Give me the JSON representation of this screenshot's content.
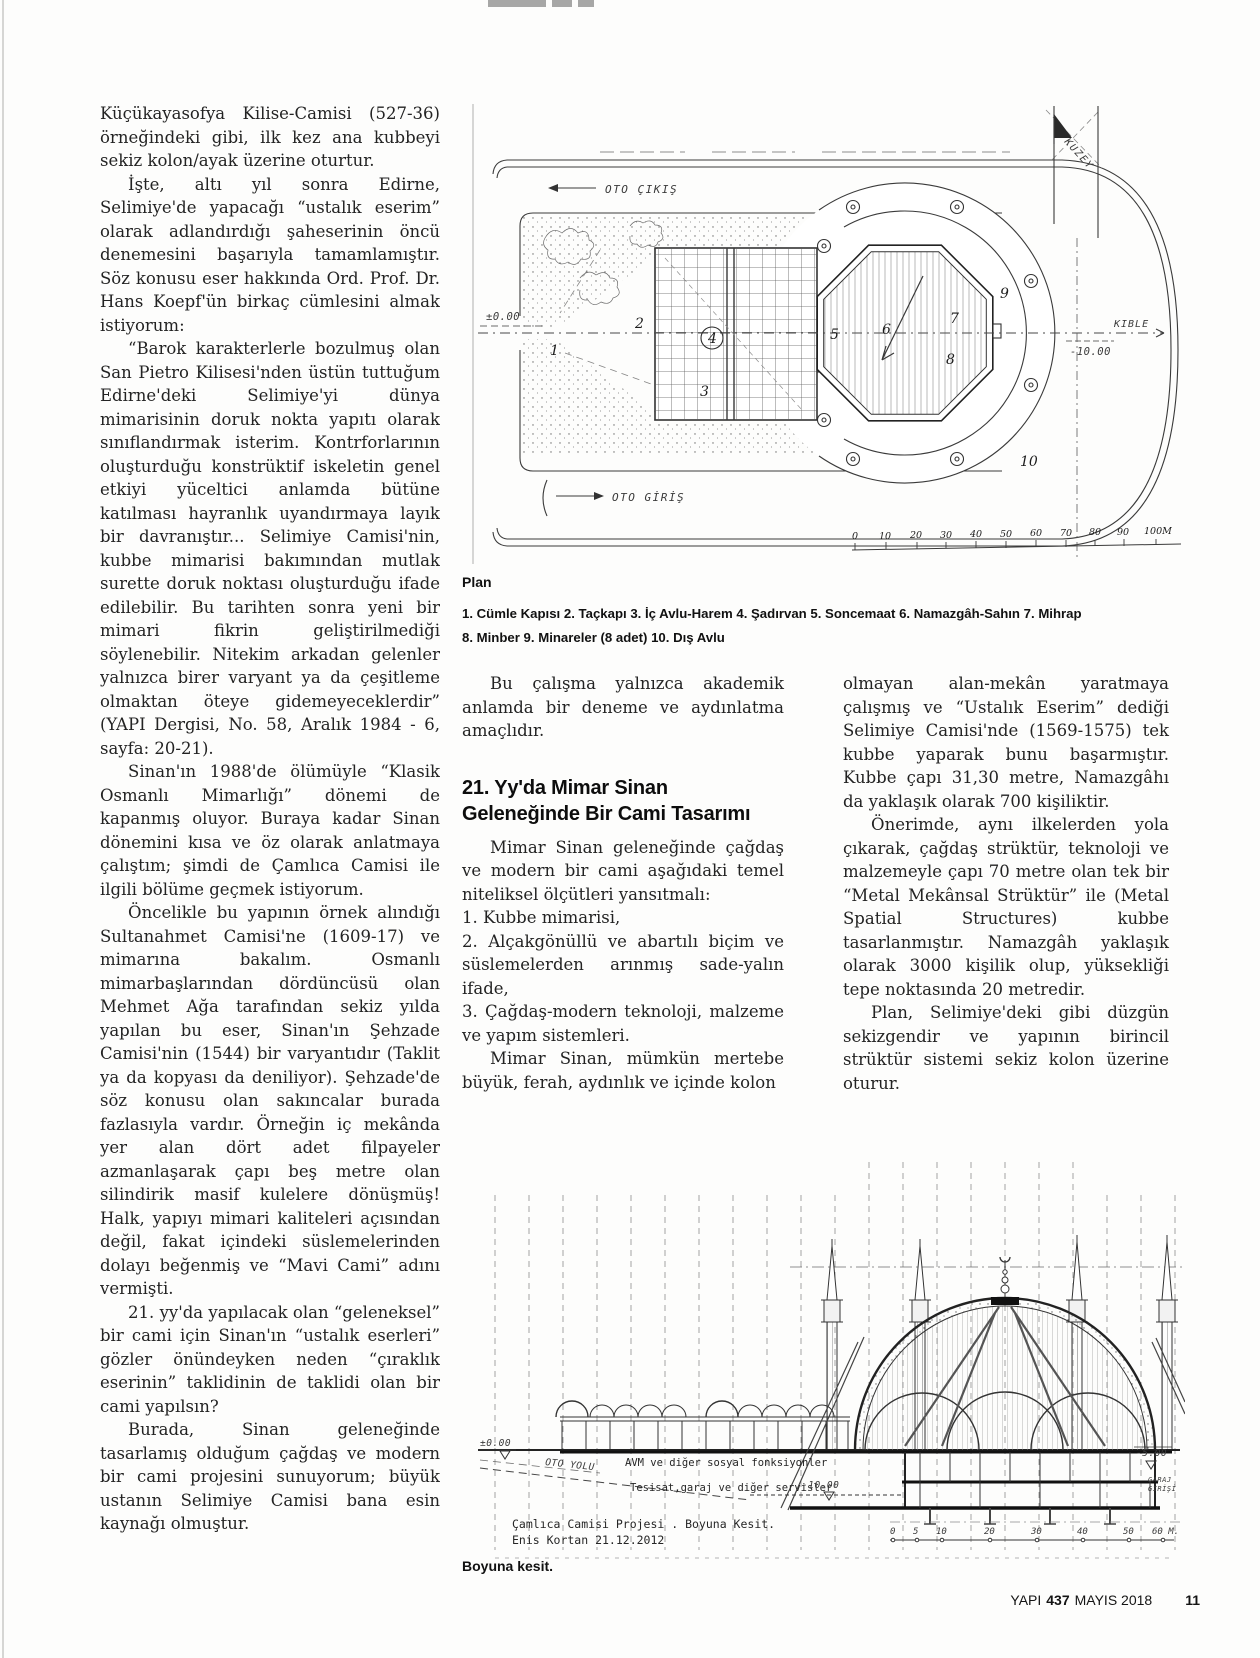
{
  "article": {
    "column1": {
      "p1": "Küçükayasofya Kilise-Camisi (527-36) örneğindeki gibi, ilk kez ana kubbeyi sekiz kolon/ayak üzerine oturtur.",
      "p2": "İşte, altı yıl sonra Edirne, Selimiye'de yapacağı “ustalık eserim” olarak adlandırdığı şaheserinin öncü denemesini başarıyla tamamlamıştır. Söz konusu eser hakkında Ord. Prof. Dr. Hans Koepf'ün birkaç cümlesini almak istiyorum:",
      "p3": "“Barok karakterlerle bozulmuş olan San Pietro Kilisesi'nden üstün tuttuğum Edirne'deki Selimiye'yi dünya mimarisinin doruk nokta yapıtı olarak sınıflandırmak isterim. Kontrforlarının oluşturduğu konstrüktif iskeletin genel etkiyi yüceltici anlamda bütüne katılması hayranlık uyandırmaya layık bir davranıştır... Selimiye Camisi'nin, kubbe mimarisi bakımından mutlak surette doruk noktası oluşturduğu ifade edilebilir. Bu tarihten sonra yeni bir mimari fikrin geliştirilmediği söylenebilir. Nitekim arkadan gelenler yalnızca birer varyant ya da çeşitleme olmaktan öteye gidemeyeceklerdir” (YAPI Dergisi, No. 58, Aralık 1984 - 6, sayfa: 20-21).",
      "p4": "Sinan'ın 1988'de ölümüyle “Klasik Osmanlı Mimarlığı” dönemi de kapanmış oluyor. Buraya kadar Sinan dönemini kısa ve öz olarak anlatmaya çalıştım; şimdi de Çamlıca Camisi ile ilgili bölüme geçmek istiyorum.",
      "p5": "Öncelikle bu yapının örnek alındığı Sultanahmet Camisi'ne (1609-17) ve mimarına bakalım. Osmanlı mimarbaşlarından dördüncüsü olan Mehmet Ağa tarafından sekiz yılda yapılan bu eser, Sinan'ın Şehzade Camisi'nin (1544) bir varyantıdır (Taklit ya da kopyası da deniliyor). Şehzade'de söz konusu olan sakıncalar burada fazlasıyla vardır. Örneğin iç mekânda yer alan dört adet filpayeler azmanlaşarak çapı beş metre olan silindirik masif kulelere dönüşmüş! Halk, yapıyı mimari kaliteleri açısından değil, fakat içindeki süslemelerinden dolayı beğenmiş ve “Mavi Cami” adını vermişti.",
      "p6": "21. yy'da yapılacak olan “geleneksel” bir cami için Sinan'ın “ustalık eserleri” gözler önündeyken neden “çıraklık eserinin” taklidinin de taklidi olan bir cami yapılsın?",
      "p7": "Burada, Sinan geleneğinde tasarlamış olduğum çağdaş ve modern bir cami projesini sunuyorum; büyük ustanın Selimiye Camisi bana esin kaynağı olmuştur."
    },
    "column2": {
      "intro": "Bu çalışma yalnızca akademik anlamda bir deneme ve aydınlatma amaçlıdır.",
      "heading": "21. Yy'da Mimar Sinan Geleneğinde Bir Cami Tasarımı",
      "p1": "Mimar Sinan geleneğinde çağdaş ve modern bir cami aşağıdaki temel niteliksel ölçütleri yansıtmalı:",
      "list": [
        "1. Kubbe mimarisi,",
        "2. Alçakgönüllü ve abartılı biçim ve süslemelerden arınmış sade-yalın ifade,",
        "3. Çağdaş-modern teknoloji, malzeme ve yapım sistemleri."
      ],
      "p2": "Mimar Sinan, mümkün mertebe büyük, ferah, aydınlık ve içinde kolon"
    },
    "column3": {
      "p1": "olmayan alan-mekân yaratmaya çalışmış ve “Ustalık Eserim” dediği Selimiye Camisi'nde (1569-1575) tek kubbe yaparak bunu başarmıştır. Kubbe çapı 31,30 metre, Namazgâhı da yaklaşık olarak 700 kişiliktir.",
      "p2": "Önerimde, aynı ilkelerden yola çıkarak, çağdaş strüktür, teknoloji ve malzemeyle çapı 70 metre olan tek bir “Metal Mekânsal Strüktür” ile (Metal Spatial Structures) kubbe tasarlanmıştır. Namazgâh yaklaşık olarak 3000 kişilik olup, yüksekliği tepe noktasında 20 metredir.",
      "p3": "Plan, Selimiye'deki gibi düzgün sekizgendir ve yapının birincil strüktür sistemi sekiz kolon üzerine oturur."
    }
  },
  "figures": {
    "plan": {
      "caption": "Plan",
      "legend1": "1. Cümle Kapısı 2. Taçkapı 3. İç Avlu-Harem 4. Şadırvan 5. Soncemaat 6. Namazgâh-Sahın 7. Mihrap",
      "legend2": "8. Minber 9. Minareler (8 adet) 10. Dış Avlu",
      "labels": {
        "oto_cikis": "OTO ÇIKIŞ",
        "oto_giris": "OTO GİRİŞ",
        "kuzey": "KUZEY",
        "kible": "KIBLE",
        "level_zero": "±0.00",
        "level_minus10": "-10.00"
      },
      "numbers": [
        "1",
        "2",
        "3",
        "4",
        "5",
        "6",
        "7",
        "8",
        "9",
        "10"
      ],
      "scale": [
        "0",
        "10",
        "20",
        "30",
        "40",
        "50",
        "60",
        "70",
        "80",
        "90",
        "100M"
      ]
    },
    "section": {
      "caption": "Boyuna kesit.",
      "labels": {
        "level_zero": "±0.00",
        "oto_yolu": "OTO YOLU",
        "avm": "AVM ve diğer sosyal fonksiyonler",
        "tesisat": "Tesisat,garaj ve diğer servisler",
        "level_minus10": "-10.00",
        "level_minus5": "-5.00",
        "garaj_line1": "GARAJ",
        "garaj_line2": "GİRİŞİ",
        "title": "Çamlıca Camisi Projesi . Boyuna Kesit.",
        "author": "Enis Kortan 21.12.2012"
      },
      "scale": [
        "0",
        "5",
        "10",
        "20",
        "30",
        "40",
        "50",
        "60 M."
      ]
    }
  },
  "footer": {
    "journal": "YAPI",
    "issue": "437",
    "date": "MAYIS 2018",
    "page_number": "11"
  }
}
